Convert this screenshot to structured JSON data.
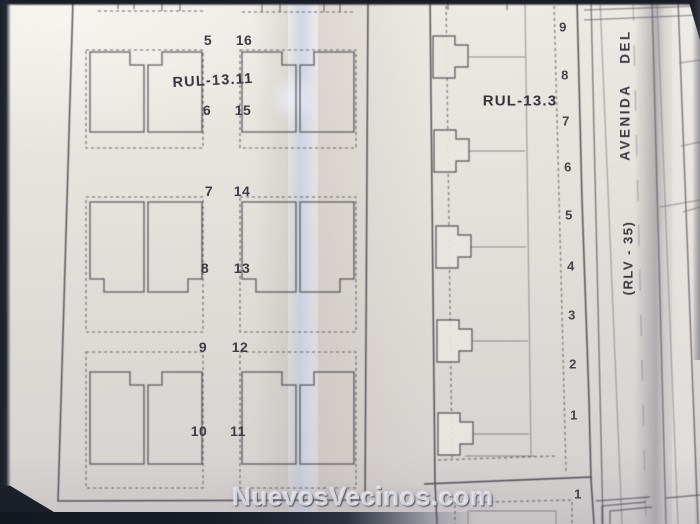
{
  "watermark_text": "NuevosVecinos.com",
  "left_block": {
    "label": "RUL-13.11",
    "numbers_left": [
      "5",
      "6",
      "7",
      "8",
      "9",
      "10"
    ],
    "numbers_right": [
      "16",
      "15",
      "14",
      "13",
      "12",
      "11"
    ]
  },
  "right_block": {
    "label": "RUL-13.3",
    "numbers": [
      "9",
      "8",
      "7",
      "6",
      "5",
      "4",
      "3",
      "2",
      "1"
    ],
    "next_block_number": "1"
  },
  "avenue": {
    "name": "AVENIDA DEL",
    "code": "(RLV - 35)"
  },
  "colors": {
    "paper": "#e7e4de",
    "ink": "#45434c",
    "photo_edge": "#1d212b",
    "fold_highlight": "#c3cde6"
  }
}
